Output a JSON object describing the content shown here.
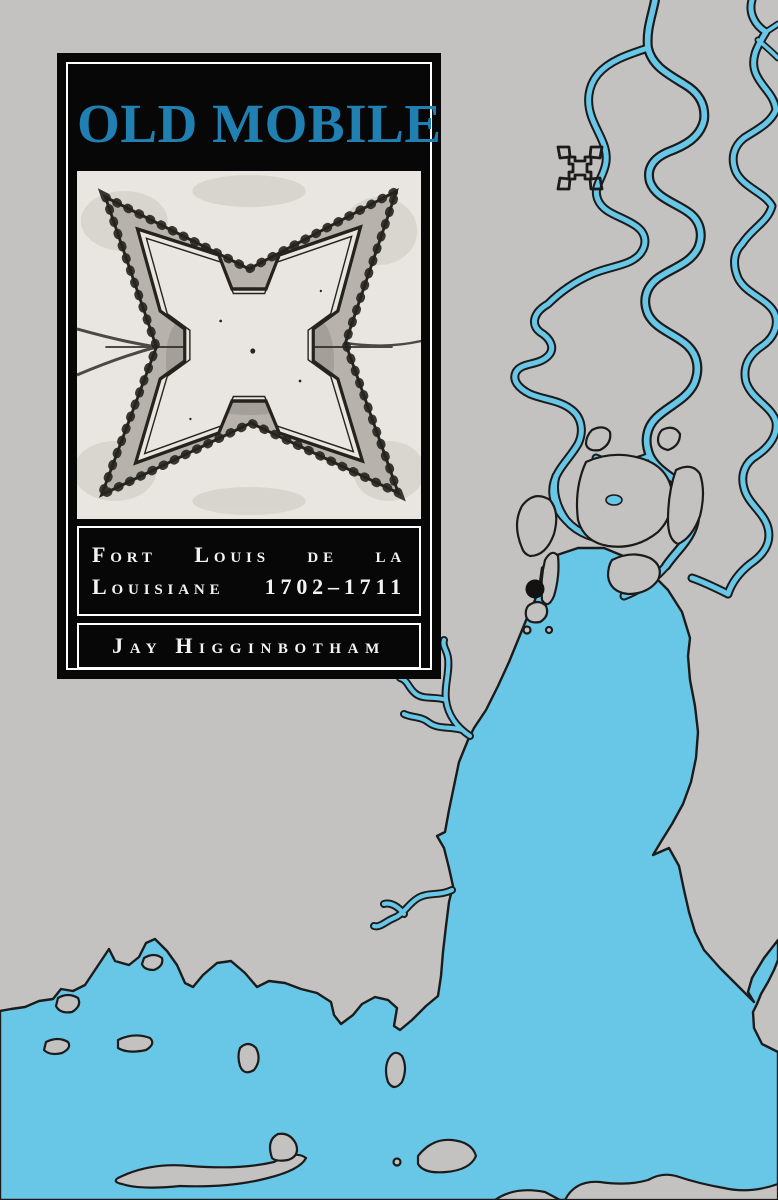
{
  "cover": {
    "title": "OLD MOBILE",
    "subtitle_line1": "Fort Louis de la",
    "subtitle_line2": "Louisiane 1702–1711",
    "author": "Jay Higginbotham"
  },
  "colors": {
    "land": "#c4c2c0",
    "water": "#68c6e6",
    "outline": "#1b1b1b",
    "panel_bg": "#070707",
    "title": "#2080b2",
    "paper": "#e9e6e1",
    "ink": "#26231f",
    "fortband": "#b7b3ac"
  },
  "map": {
    "fort_icon": "star-fort-symbol",
    "site_marker": "settlement-dot",
    "water_bodies": [
      "river delta",
      "Mobile Bay",
      "gulf coast",
      "barrier islands"
    ]
  },
  "engraving": {
    "subject": "plan of four-bastioned star fort"
  }
}
